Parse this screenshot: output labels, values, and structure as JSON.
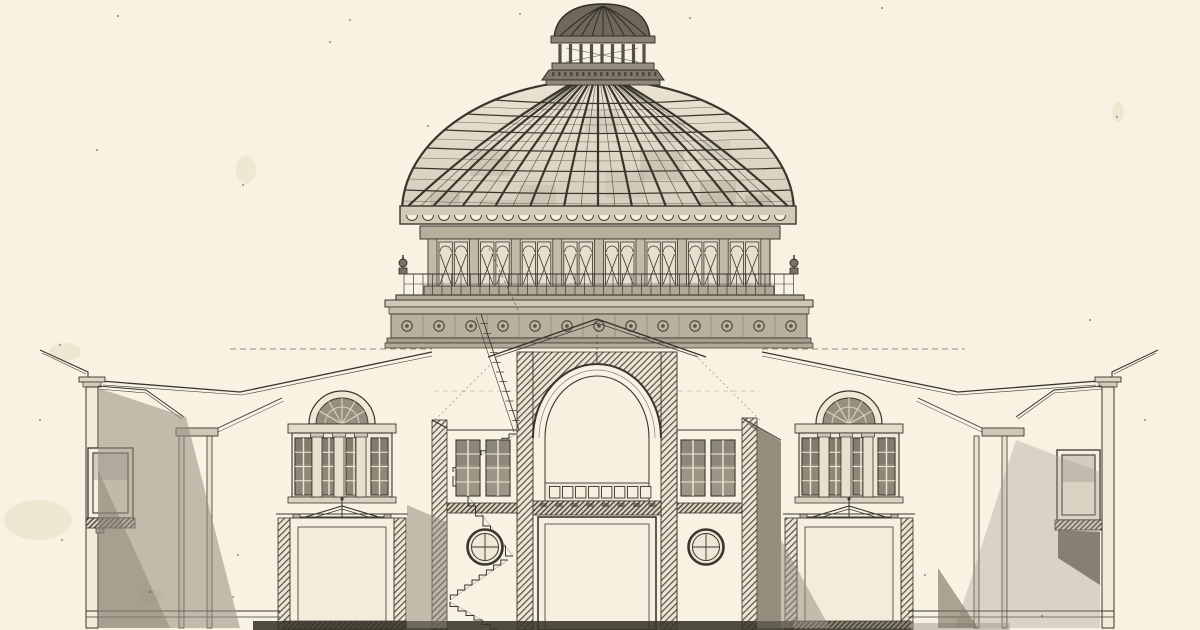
{
  "meta": {
    "subject": "architectural cross-section engraving of a domed pavilion building",
    "visible_text": "",
    "canvas": {
      "width": 1200,
      "height": 630
    }
  },
  "palette": {
    "paper": "#f8f2e3",
    "ink": "#3a362d",
    "ink_light": "#6b655a",
    "glass_dome_top": "#eae3d2",
    "glass_dome_bottom": "#d5cebc",
    "glass_window": "#9d9687",
    "glass_group": "#8e8879",
    "stone_band": "#b7b09e",
    "shadow_wash": "#8f8878",
    "dark_band": "#393429",
    "cream": "#f6efdf"
  },
  "drawing": {
    "dome": {
      "cx": 598,
      "baseY": 212,
      "rx": 196,
      "ry": 132,
      "apexY": 84,
      "topSpread": 0.14,
      "ribBaseXs": [
        402,
        428,
        458,
        492,
        528,
        563,
        598,
        633,
        668,
        704,
        738,
        768,
        794
      ],
      "ringYs": [
        100,
        114,
        130,
        148,
        168,
        190
      ],
      "subRingYs": [
        107,
        122,
        139,
        158,
        179,
        201
      ],
      "patches": [
        [
          470,
          150,
          40,
          26,
          0.18
        ],
        [
          585,
          110,
          34,
          22,
          0.15
        ],
        [
          640,
          150,
          44,
          30,
          0.2
        ],
        [
          700,
          180,
          36,
          26,
          0.22
        ],
        [
          520,
          185,
          36,
          24,
          0.15
        ],
        [
          430,
          190,
          30,
          22,
          0.2
        ],
        [
          605,
          170,
          40,
          28,
          0.12
        ],
        [
          745,
          195,
          26,
          18,
          0.25
        ],
        [
          555,
          95,
          26,
          16,
          0.15
        ],
        [
          655,
          120,
          30,
          20,
          0.15
        ],
        [
          480,
          200,
          40,
          20,
          0.15
        ],
        [
          700,
          140,
          30,
          20,
          0.12
        ]
      ]
    },
    "scallops": {
      "y": 215,
      "r": 5.5,
      "from": 412,
      "to": 788,
      "step": 16
    },
    "lantern": {
      "capRibT": [
        -1,
        -0.75,
        -0.5,
        -0.25,
        0,
        0.25,
        0.5,
        0.75,
        1
      ],
      "columns": {
        "from": 560,
        "to": 644,
        "count": 9,
        "y1": 44,
        "y2": 63,
        "w": 3.2
      },
      "dentils": {
        "from": 552,
        "to": 654,
        "step": 6,
        "y": 72,
        "h": 4
      }
    },
    "drum": {
      "x": 428,
      "y1": 242,
      "y2": 286,
      "pilStep": 41.6,
      "pilCount": 9,
      "pilW": 9
    },
    "balusters": {
      "from": 404,
      "to": 794,
      "step": 9.5,
      "y1": 274,
      "y2": 296
    },
    "rosettes": {
      "startX": 407,
      "step": 32,
      "count": 13,
      "y": 326,
      "r": 5.2
    },
    "squares": {
      "x": 549.5,
      "y": 486.5,
      "w": 10.4,
      "h": 11.5,
      "gap": 2.6,
      "count": 8
    },
    "dentilRow": {
      "from": 540,
      "step": 15.5,
      "count": 8,
      "y": 503,
      "w": 7,
      "h": 4
    },
    "windows": [
      {
        "x": 456,
        "y": 440,
        "w": 24,
        "h": 56,
        "cols": 2,
        "rows": 4,
        "tint": "#9d9687"
      },
      {
        "x": 486,
        "y": 440,
        "w": 24,
        "h": 56,
        "cols": 2,
        "rows": 4,
        "tint": "#9d9687"
      },
      {
        "x": 681,
        "y": 440,
        "w": 24,
        "h": 56,
        "cols": 2,
        "rows": 4,
        "tint": "#9d9687"
      },
      {
        "x": 711,
        "y": 440,
        "w": 24,
        "h": 56,
        "cols": 2,
        "rows": 4,
        "tint": "#9d9687"
      },
      {
        "x": 295,
        "y": 438,
        "w": 17,
        "h": 57,
        "cols": 2,
        "rows": 4,
        "tint": "#8e8879"
      },
      {
        "x": 321,
        "y": 438,
        "w": 16,
        "h": 57,
        "cols": 2,
        "rows": 4,
        "tint": "#8e8879"
      },
      {
        "x": 346,
        "y": 438,
        "w": 16,
        "h": 57,
        "cols": 2,
        "rows": 4,
        "tint": "#8e8879"
      },
      {
        "x": 371,
        "y": 438,
        "w": 17,
        "h": 57,
        "cols": 2,
        "rows": 4,
        "tint": "#8e8879"
      },
      {
        "x": 802,
        "y": 438,
        "w": 17,
        "h": 57,
        "cols": 2,
        "rows": 4,
        "tint": "#8e8879"
      },
      {
        "x": 828,
        "y": 438,
        "w": 16,
        "h": 57,
        "cols": 2,
        "rows": 4,
        "tint": "#8e8879"
      },
      {
        "x": 853,
        "y": 438,
        "w": 16,
        "h": 57,
        "cols": 2,
        "rows": 4,
        "tint": "#8e8879"
      },
      {
        "x": 878,
        "y": 438,
        "w": 17,
        "h": 57,
        "cols": 2,
        "rows": 4,
        "tint": "#8e8879"
      },
      {
        "x": 93,
        "y": 453,
        "w": 35,
        "h": 60,
        "cols": 1,
        "rows": 1,
        "tint": "#f7f0e1"
      },
      {
        "x": 1062,
        "y": 455,
        "w": 33,
        "h": 60,
        "cols": 1,
        "rows": 1,
        "tint": "#f7f0e1"
      }
    ],
    "pilasterStrips": [
      {
        "xs": [
          312,
          334,
          356
        ],
        "y": 433,
        "w": 10,
        "h": 64
      },
      {
        "xs": [
          819,
          841,
          863
        ],
        "y": 433,
        "w": 10,
        "h": 64
      }
    ],
    "lunettes": [
      {
        "cx": 342,
        "cy": 424
      },
      {
        "cx": 849,
        "cy": 424
      }
    ],
    "portholes": [
      {
        "cx": 485,
        "cy": 547
      },
      {
        "cx": 706,
        "cy": 547
      }
    ],
    "stairs": {
      "flights": [
        {
          "x": 516,
          "y": 434,
          "n": 9,
          "dx": -7,
          "dy": 4.2,
          "mode": "hv"
        },
        {
          "x": 453,
          "y": 476,
          "n": 8,
          "dx": 7.5,
          "dy": 10,
          "mode": "vh"
        },
        {
          "x": 508,
          "y": 560,
          "n": 8,
          "dx": -7.2,
          "dy": 5,
          "mode": "hv"
        },
        {
          "x": 450,
          "y": 602,
          "n": 6,
          "dx": 8,
          "dy": 4.5,
          "mode": "vh"
        }
      ],
      "stringers": [
        [
          481,
          314,
          519,
          430
        ],
        [
          476,
          317,
          514,
          432
        ]
      ],
      "dashedRun": [
        489,
        248,
        519,
        312
      ],
      "ticks": 12
    },
    "specks": [
      [
        118,
        16
      ],
      [
        330,
        42
      ],
      [
        520,
        14
      ],
      [
        97,
        150
      ],
      [
        60,
        345
      ],
      [
        243,
        185
      ],
      [
        40,
        420
      ],
      [
        150,
        592
      ],
      [
        233,
        597
      ],
      [
        1117,
        117
      ],
      [
        1042,
        616
      ],
      [
        925,
        575
      ],
      [
        1145,
        420
      ],
      [
        690,
        18
      ],
      [
        428,
        126
      ],
      [
        1090,
        320
      ],
      [
        238,
        555
      ],
      [
        62,
        540
      ],
      [
        350,
        20
      ],
      [
        882,
        8
      ]
    ],
    "stains": [
      [
        65,
        352,
        16,
        9
      ],
      [
        38,
        520,
        34,
        20
      ],
      [
        152,
        596,
        12,
        7
      ],
      [
        246,
        170,
        10,
        14
      ],
      [
        1118,
        112,
        6,
        10
      ]
    ]
  }
}
